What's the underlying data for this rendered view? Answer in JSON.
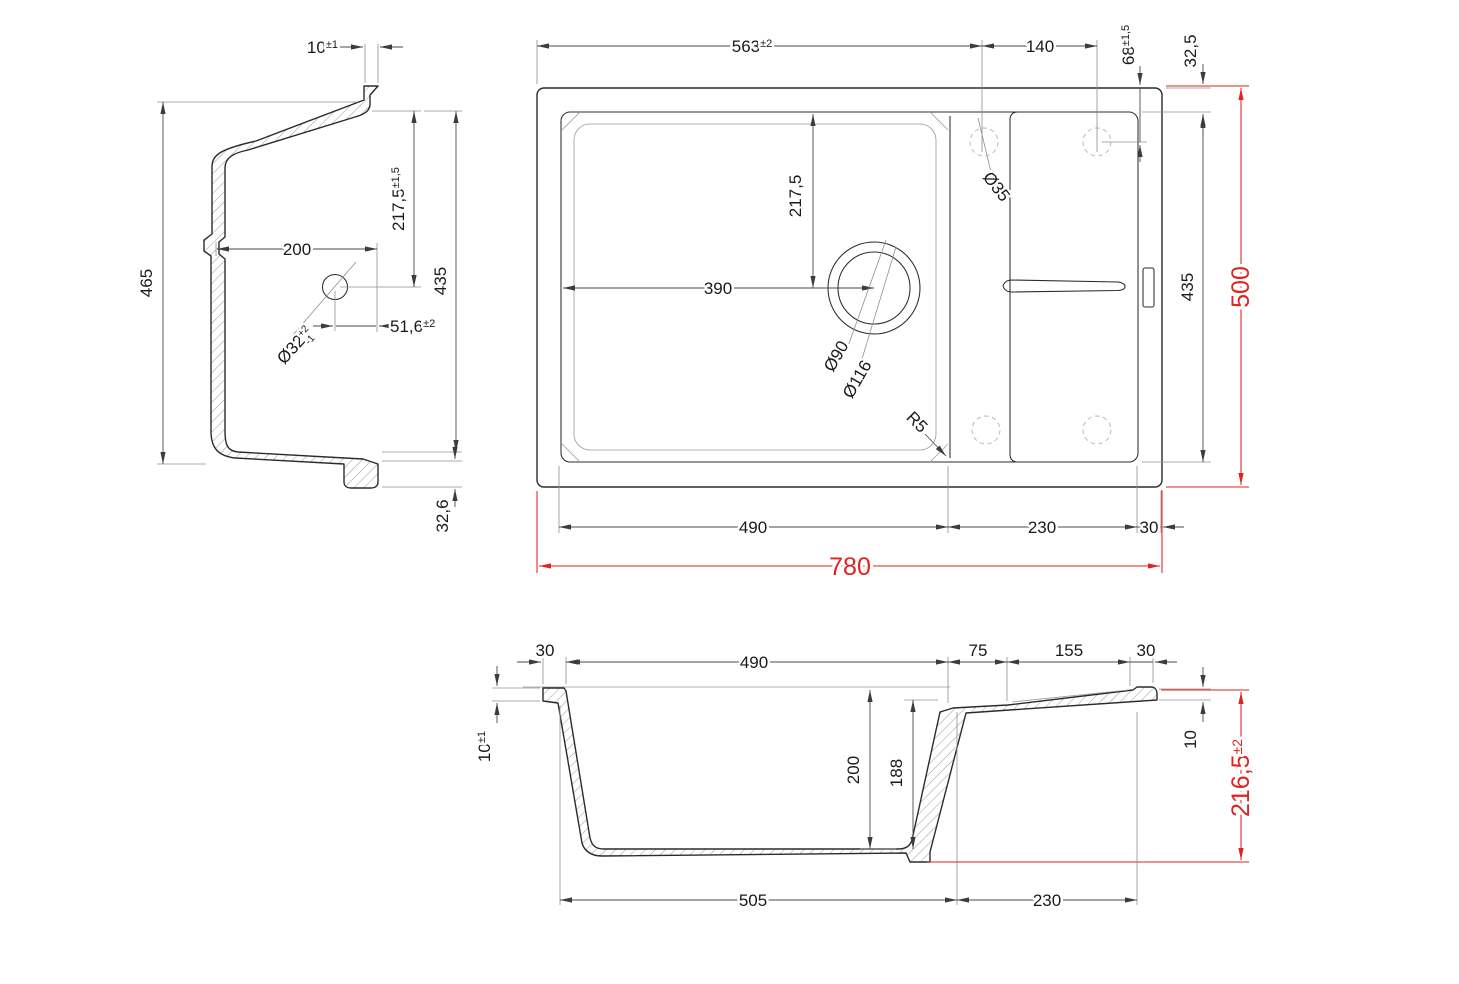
{
  "title": "sink-technical-drawing",
  "colors": {
    "outline": "#2b2b2b",
    "dim_line": "#4a4a4a",
    "extension_line": "#8f8f8f",
    "hatch": "#6f6f6f",
    "dashed_hole": "#b2b2b2",
    "red_dim": "#e0231f",
    "background": "#ffffff"
  },
  "side_view": {
    "dims": {
      "rim_width": {
        "value": "10",
        "tol": "±1"
      },
      "outer_depth": {
        "value": "465"
      },
      "bowl_inner": {
        "value": "200"
      },
      "drain_center_depth": {
        "value": "217,5",
        "tol": "±1,5"
      },
      "inner_depth": {
        "value": "435"
      },
      "drain_hole": {
        "value": "Ø32",
        "tol_sup": "+2",
        "tol_sub": "-1"
      },
      "drain_center_offset": {
        "value": "51,6",
        "tol": "±2"
      },
      "base_step": {
        "value": "32,6"
      }
    }
  },
  "plan_view": {
    "dims": {
      "tap_center_from_left": {
        "value": "563",
        "tol": "±2"
      },
      "tap_hole_spacing": {
        "value": "140"
      },
      "tap_center_from_top": {
        "value": "68",
        "tol": "±1,5"
      },
      "rim_width_top": {
        "value": "32,5"
      },
      "drain_center_from_top": {
        "value": "217,5"
      },
      "drain_center_from_left": {
        "value": "390"
      },
      "tap_hole_diameter": {
        "value": "Ø35"
      },
      "drain_diameter_inner": {
        "value": "Ø90"
      },
      "drain_diameter_outer": {
        "value": "Ø116"
      },
      "inner_width": {
        "value": "435"
      },
      "overall_width": {
        "value": "500"
      },
      "corner_radius": {
        "value": "R5"
      },
      "bowl_length": {
        "value": "490"
      },
      "drainer_length": {
        "value": "230"
      },
      "rim_width_right": {
        "value": "30"
      },
      "overall_length": {
        "value": "780"
      }
    }
  },
  "front_view": {
    "dims": {
      "rim_width_left": {
        "value": "30"
      },
      "bowl_opening": {
        "value": "490"
      },
      "ledge_width": {
        "value": "75"
      },
      "drainer_width": {
        "value": "155"
      },
      "rim_width_right": {
        "value": "30"
      },
      "rim_height": {
        "value": "10",
        "tol": "±1"
      },
      "bowl_depth": {
        "value": "200"
      },
      "bowl_inner_depth": {
        "value": "188"
      },
      "deck_thickness": {
        "value": "10"
      },
      "overall_height": {
        "value": "216,5",
        "tol": "±2"
      },
      "bowl_outer_length": {
        "value": "505"
      },
      "drainer_span": {
        "value": "230"
      }
    }
  }
}
